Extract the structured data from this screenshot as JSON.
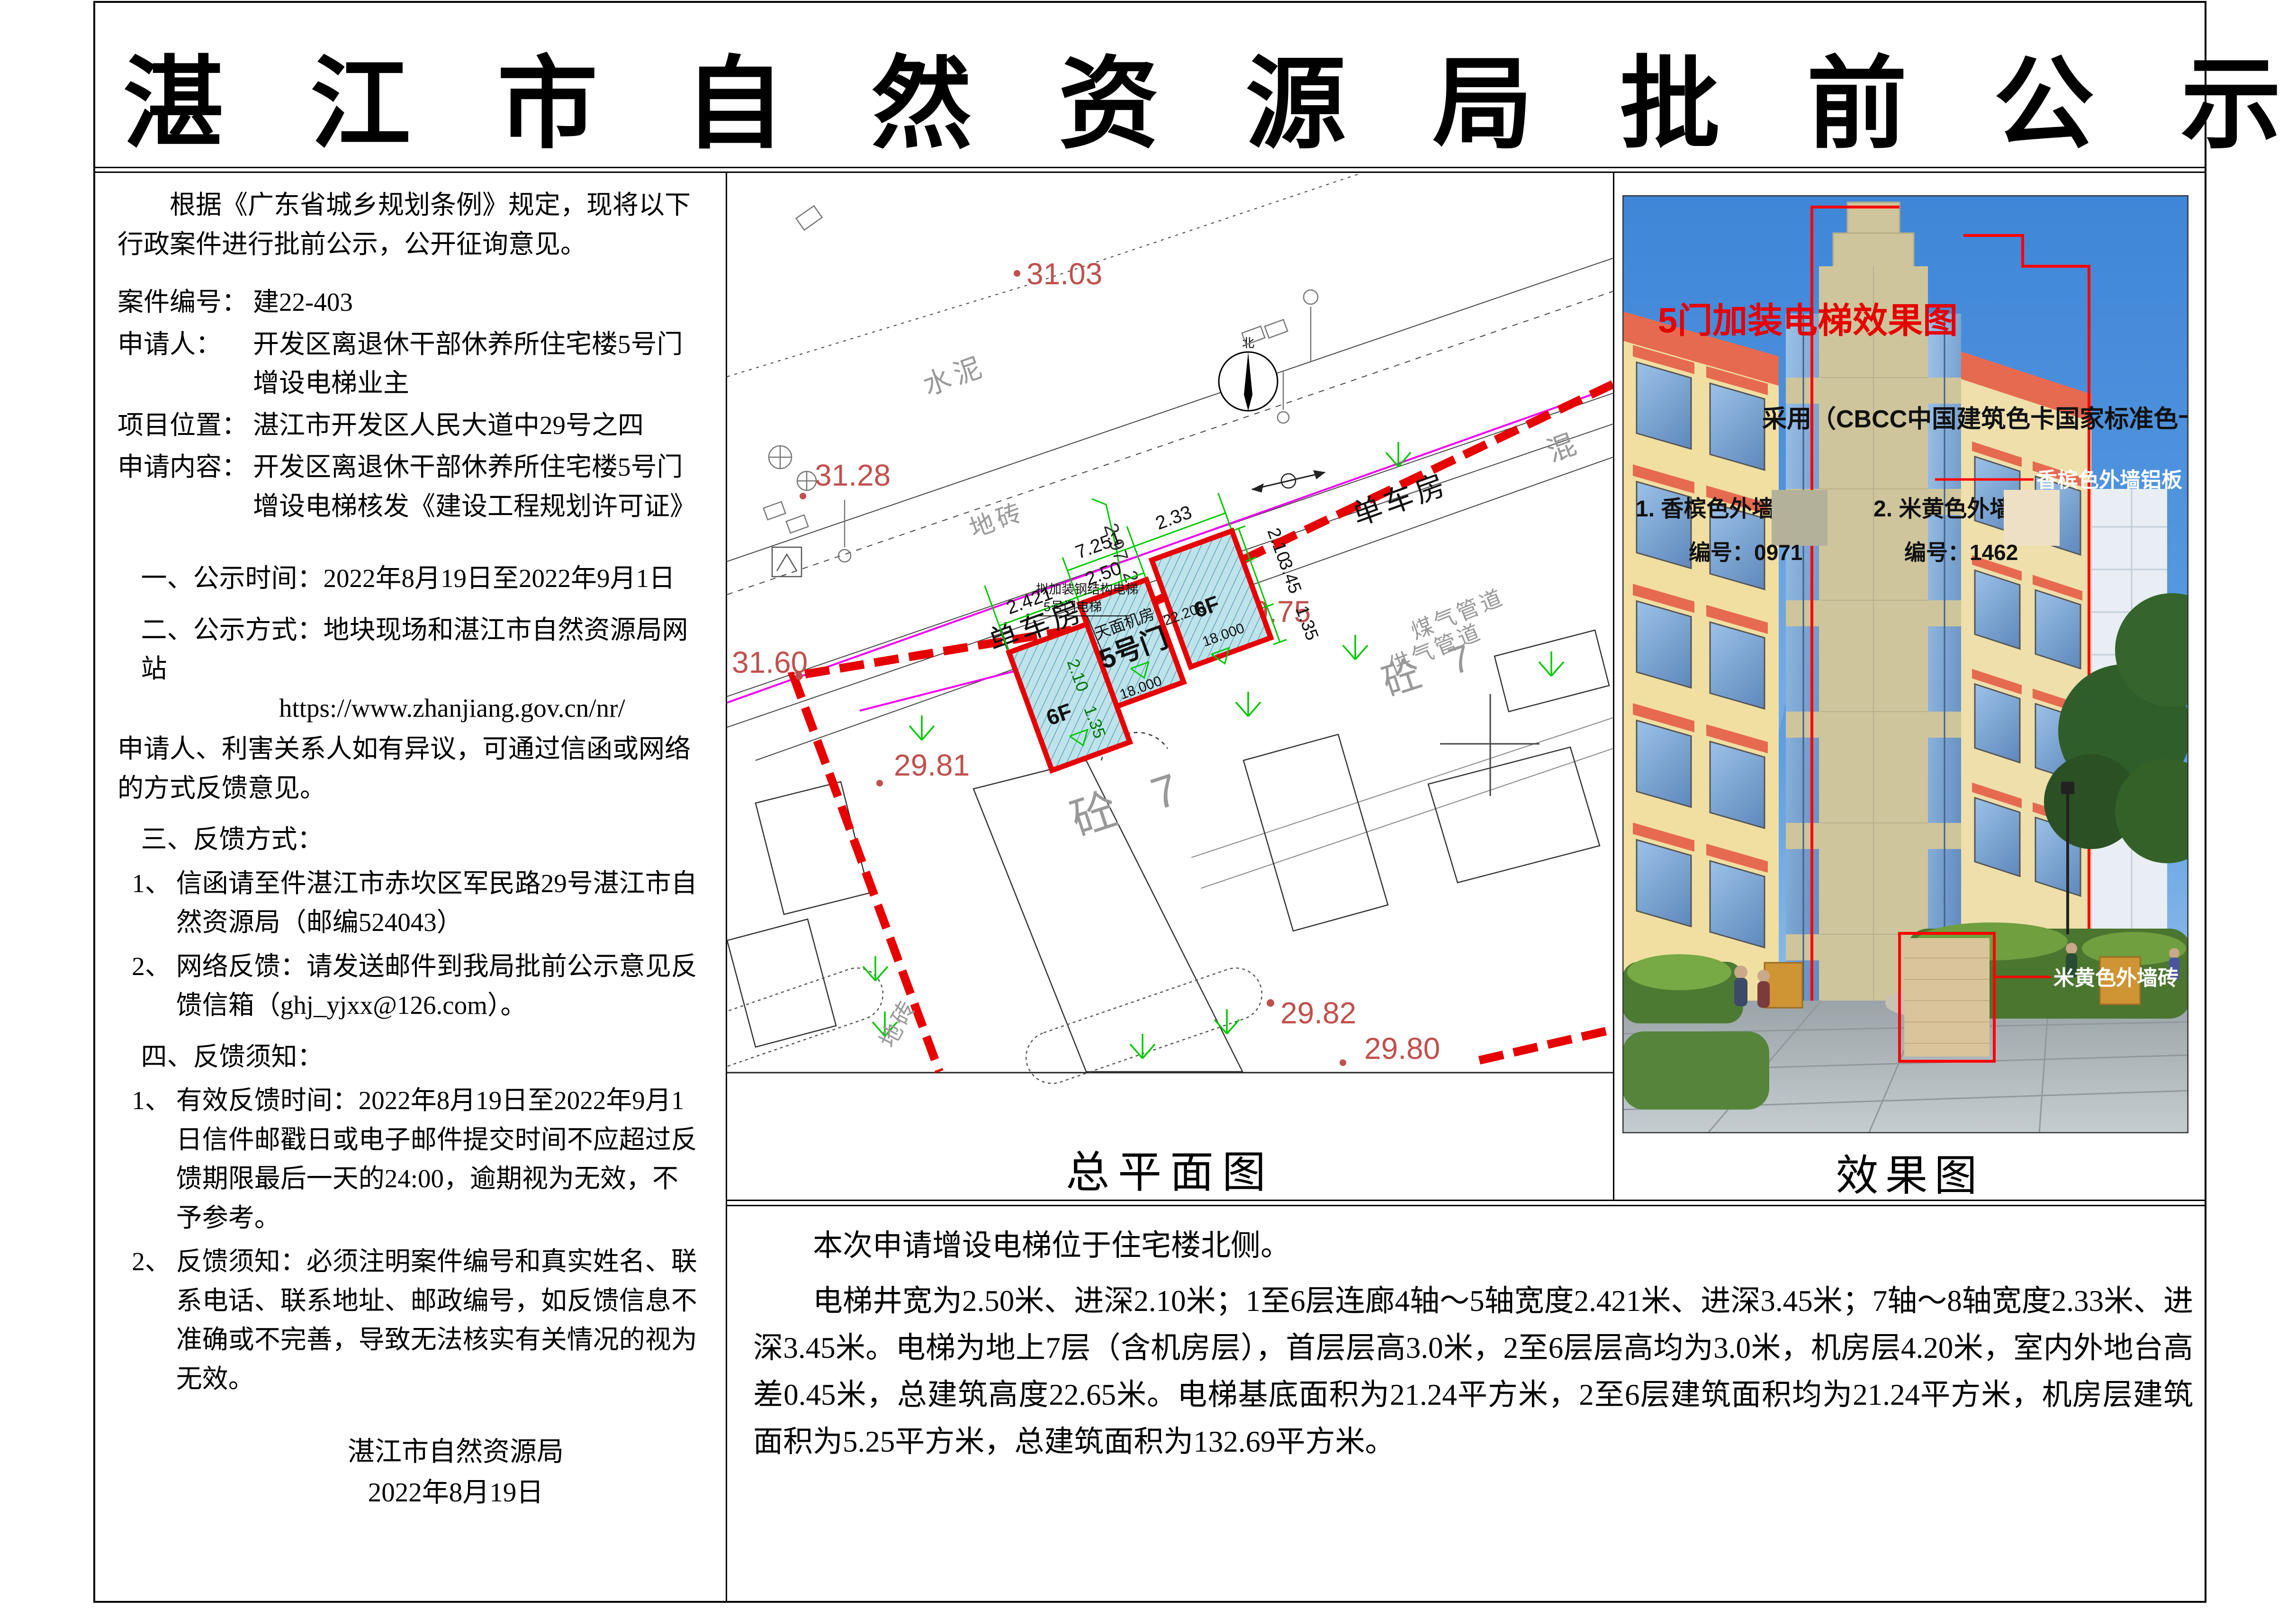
{
  "page": {
    "title": "湛 江 市 自 然 资 源 局 批 前 公 示"
  },
  "notice": {
    "intro": "根据《广东省城乡规划条例》规定，现将以下行政案件进行批前公示，公开征询意见。",
    "fields": [
      {
        "label": "案件编号：",
        "value": "建22-403"
      },
      {
        "label": "申请人：",
        "value": "开发区离退休干部休养所住宅楼5号门增设电梯业主"
      },
      {
        "label": "项目位置：",
        "value": "湛江市开发区人民大道中29号之四"
      },
      {
        "label": "申请内容：",
        "value": "开发区离退休干部休养所住宅楼5号门增设电梯核发《建设工程规划许可证》"
      }
    ],
    "item_time": "一、公示时间：2022年8月19日至2022年9月1日",
    "item_method": "二、公示方式：地块现场和湛江市自然资源局网站",
    "item_url": "https://www.zhanjiang.gov.cn/nr/",
    "item_objection": "申请人、利害关系人如有异议，可通过信函或网络的方式反馈意见。",
    "item_feedback_header": "三、反馈方式：",
    "item_feedback_1_marker": "1、",
    "item_feedback_1": "信函请至件湛江市赤坎区军民路29号湛江市自然资源局（邮编524043）",
    "item_feedback_2_marker": "2、",
    "item_feedback_2": "网络反馈：请发送邮件到我局批前公示意见反馈信箱（ghj_yjxx@126.com）。",
    "item_notes_header": "四、反馈须知：",
    "item_notes_1_marker": "1、",
    "item_notes_1": "有效反馈时间：2022年8月19日至2022年9月1日信件邮戳日或电子邮件提交时间不应超过反馈期限最后一天的24:00，逾期视为无效，不予参考。",
    "item_notes_2_marker": "2、",
    "item_notes_2": "反馈须知：必须注明案件编号和真实姓名、联系电话、联系地址、邮政编号，如反馈信息不准确或不完善，导致无法核实有关情况的视为无效。",
    "signature": "湛江市自然资源局",
    "date": "2022年8月19日"
  },
  "site_plan": {
    "caption": "总平面图",
    "north_label": "北",
    "labels": {
      "bike1": "单车房",
      "bike2": "单车房",
      "cement1": "水泥",
      "cement2": "水泥",
      "brick1": "地砖",
      "brick2": "地砖",
      "mix": "混",
      "conc1": "砼 7",
      "conc2": "砼 7",
      "pipe1": "煤气管道",
      "pipe2": "供气管道"
    },
    "elevations": [
      "31.03",
      "31.28",
      "31.60",
      "29.75",
      "29.81",
      "29.82",
      "29.80"
    ],
    "dims": [
      "2.421",
      "2.50",
      "7.251",
      "2.33",
      "2.97",
      "2.31",
      "2.10",
      "3.45",
      "1.35",
      "2.10",
      "1.35"
    ],
    "block": {
      "floors_left": "6F",
      "floors_right": "6F",
      "machine_room": "天面机房",
      "door": "5号门",
      "level_mid": "22.200",
      "level_left": "18.000",
      "level_right": "18.000",
      "note1": "拟加装钢结构电梯",
      "note2": "5号门电梯"
    }
  },
  "rendering": {
    "title": "5门加装电梯效果图",
    "subtitle": "采用（CBCC中国建筑色卡国家标准色卡0971色）",
    "legend": [
      {
        "name": "1. 香槟色外墙铝板",
        "code": "编号：0971",
        "color": "#B3B199"
      },
      {
        "name": "2. 米黄色外墙砖",
        "code": "编号：1462",
        "color": "#EEE0C4"
      }
    ],
    "ann_champagne": "香槟色外墙铝板",
    "ann_beige": "米黄色外墙砖",
    "caption": "效果图"
  },
  "summary": {
    "p1": "本次申请增设电梯位于住宅楼北侧。",
    "p2": "电梯井宽为2.50米、进深2.10米；1至6层连廊4轴～5轴宽度2.421米、进深3.45米；7轴～8轴宽度2.33米、进深3.45米。电梯为地上7层（含机房层），首层层高3.0米，2至6层层高均为3.0米，机房层4.20米，室内外地台高差0.45米，总建筑高度22.65米。电梯基底面积为21.24平方米，2至6层建筑面积均为21.24平方米，机房层建筑面积为5.25平方米，总建筑面积为132.69平方米。"
  },
  "colors": {
    "accent_red": "#E60000",
    "elevation_red": "#C0504D",
    "cad_green": "#00C800",
    "cad_magenta": "#F000F0",
    "hatch_blue": "#BFE3EA",
    "sky_blue": "#4E97E0",
    "roof_red": "#E66A50",
    "champagne_wall": "#CFC59C",
    "yellow_wall": "#F1DFA2"
  }
}
